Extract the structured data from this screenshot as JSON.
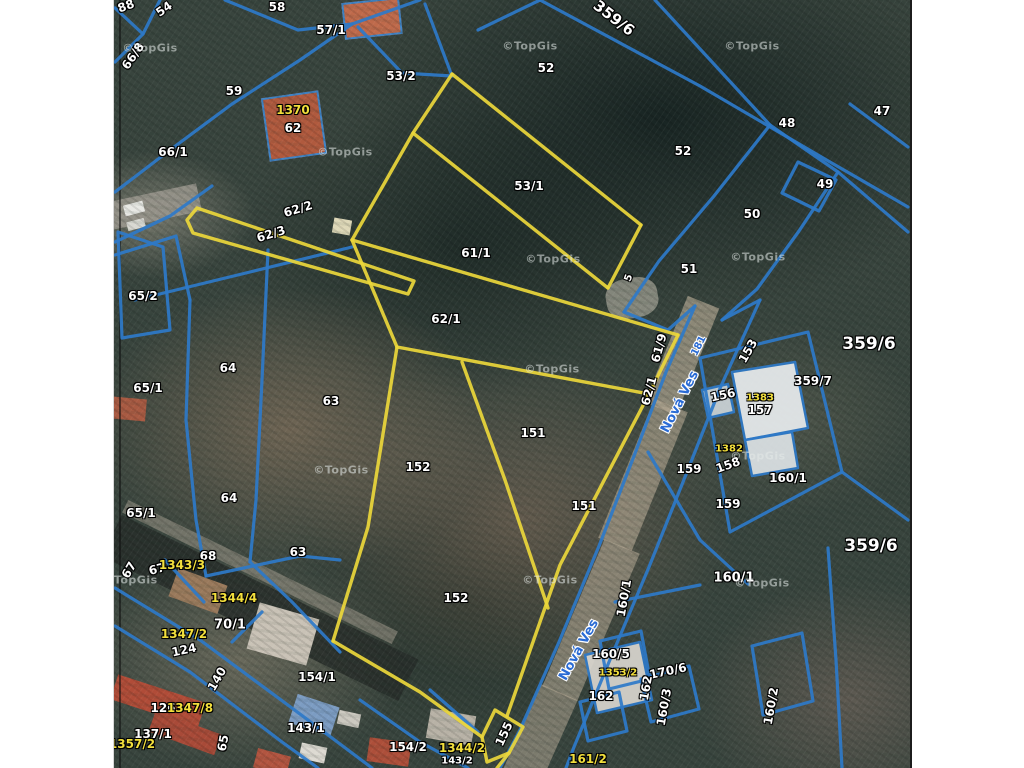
{
  "map": {
    "type": "cadastral-parcel-map-over-aerial-photo",
    "watermark_text": "©TopGis",
    "street_name": "Nová Ves",
    "colors": {
      "parcel_line_blue": "#2e7ac9",
      "highlight_line_yellow": "#ecd73b",
      "label_white": "#ffffff",
      "label_yellow": "#f2df3c",
      "street_label_blue": "#2a6bd4",
      "paper_margin": "#ffffff"
    },
    "highlighted_parcels": [
      "53/1",
      "61/1",
      "62/1",
      "62/3",
      "151",
      "152",
      "155"
    ],
    "labels": [
      {
        "t": "88",
        "x": 126,
        "y": 6,
        "r": -20
      },
      {
        "t": "54",
        "x": 164,
        "y": 9,
        "r": -35
      },
      {
        "t": "58",
        "x": 277,
        "y": 7
      },
      {
        "t": "57/1",
        "x": 331,
        "y": 30
      },
      {
        "t": "53/2",
        "x": 401,
        "y": 76
      },
      {
        "t": "52",
        "x": 546,
        "y": 68
      },
      {
        "t": "359/6",
        "x": 614,
        "y": 18,
        "r": 38,
        "s": 15
      },
      {
        "t": "59",
        "x": 234,
        "y": 91
      },
      {
        "t": "1370",
        "x": 293,
        "y": 110,
        "c": "y"
      },
      {
        "t": "62",
        "x": 293,
        "y": 128
      },
      {
        "t": "66/8",
        "x": 133,
        "y": 56,
        "r": -55
      },
      {
        "t": "66/1",
        "x": 173,
        "y": 152
      },
      {
        "t": "52",
        "x": 683,
        "y": 151
      },
      {
        "t": "48",
        "x": 787,
        "y": 123
      },
      {
        "t": "47",
        "x": 882,
        "y": 111
      },
      {
        "t": "49",
        "x": 825,
        "y": 184
      },
      {
        "t": "50",
        "x": 752,
        "y": 214
      },
      {
        "t": "53/1",
        "x": 529,
        "y": 186
      },
      {
        "t": "51",
        "x": 689,
        "y": 269
      },
      {
        "t": "62/2",
        "x": 298,
        "y": 209,
        "r": -17
      },
      {
        "t": "62/3",
        "x": 271,
        "y": 234,
        "r": -17
      },
      {
        "t": "61/1",
        "x": 476,
        "y": 253
      },
      {
        "t": "5",
        "x": 629,
        "y": 278,
        "r": -70,
        "s": 10
      },
      {
        "t": "65/2",
        "x": 143,
        "y": 296
      },
      {
        "t": "62/1",
        "x": 446,
        "y": 319
      },
      {
        "t": "64",
        "x": 228,
        "y": 368
      },
      {
        "t": "61/9",
        "x": 659,
        "y": 348,
        "r": -75
      },
      {
        "t": "65/1",
        "x": 148,
        "y": 388
      },
      {
        "t": "63",
        "x": 331,
        "y": 401
      },
      {
        "t": "62/1",
        "x": 649,
        "y": 391,
        "r": -75
      },
      {
        "t": "359/6",
        "x": 869,
        "y": 344,
        "s": 17
      },
      {
        "t": "359/7",
        "x": 813,
        "y": 381
      },
      {
        "t": "153",
        "x": 748,
        "y": 351,
        "r": -60
      },
      {
        "t": "156",
        "x": 723,
        "y": 395,
        "r": -12
      },
      {
        "t": "1383",
        "x": 760,
        "y": 398,
        "c": "y",
        "s": 10
      },
      {
        "t": "157",
        "x": 760,
        "y": 410
      },
      {
        "t": "151",
        "x": 533,
        "y": 433
      },
      {
        "t": "1382",
        "x": 729,
        "y": 449,
        "c": "y",
        "s": 10
      },
      {
        "t": "158",
        "x": 728,
        "y": 465,
        "r": -20
      },
      {
        "t": "159",
        "x": 689,
        "y": 469
      },
      {
        "t": "160/1",
        "x": 788,
        "y": 478
      },
      {
        "t": "152",
        "x": 418,
        "y": 467
      },
      {
        "t": "159",
        "x": 728,
        "y": 504
      },
      {
        "t": "151",
        "x": 584,
        "y": 506
      },
      {
        "t": "64",
        "x": 229,
        "y": 498
      },
      {
        "t": "65/1",
        "x": 141,
        "y": 513
      },
      {
        "t": "68",
        "x": 208,
        "y": 556
      },
      {
        "t": "63",
        "x": 298,
        "y": 552
      },
      {
        "t": "67",
        "x": 129,
        "y": 570,
        "r": -60
      },
      {
        "t": "67",
        "x": 157,
        "y": 569,
        "r": -15
      },
      {
        "t": "1343/3",
        "x": 182,
        "y": 565,
        "c": "y"
      },
      {
        "t": "152",
        "x": 456,
        "y": 598
      },
      {
        "t": "359/6",
        "x": 871,
        "y": 546,
        "s": 17
      },
      {
        "t": "160/1",
        "x": 734,
        "y": 578,
        "s": 13
      },
      {
        "t": "160/1",
        "x": 624,
        "y": 598,
        "r": -80
      },
      {
        "t": "1344/4",
        "x": 234,
        "y": 598,
        "c": "y"
      },
      {
        "t": "70/1",
        "x": 230,
        "y": 625,
        "s": 13
      },
      {
        "t": "1347/2",
        "x": 184,
        "y": 634,
        "c": "y"
      },
      {
        "t": "124",
        "x": 184,
        "y": 650,
        "r": -12
      },
      {
        "t": "140",
        "x": 217,
        "y": 679,
        "r": -60
      },
      {
        "t": "154/1",
        "x": 317,
        "y": 677
      },
      {
        "t": "160/5",
        "x": 611,
        "y": 654
      },
      {
        "t": "1353/2",
        "x": 618,
        "y": 673,
        "c": "y",
        "s": 10
      },
      {
        "t": "170/6",
        "x": 668,
        "y": 671,
        "r": -12
      },
      {
        "t": "162",
        "x": 646,
        "y": 688,
        "r": -80
      },
      {
        "t": "162",
        "x": 601,
        "y": 696
      },
      {
        "t": "160/3",
        "x": 664,
        "y": 707,
        "r": -80
      },
      {
        "t": "160/2",
        "x": 771,
        "y": 706,
        "r": -80
      },
      {
        "t": "126",
        "x": 163,
        "y": 708
      },
      {
        "t": "1347/8",
        "x": 190,
        "y": 708,
        "c": "y"
      },
      {
        "t": "137/1",
        "x": 153,
        "y": 734
      },
      {
        "t": "1357/2",
        "x": 132,
        "y": 744,
        "c": "y"
      },
      {
        "t": "143/1",
        "x": 306,
        "y": 728
      },
      {
        "t": "65",
        "x": 223,
        "y": 743,
        "r": -80
      },
      {
        "t": "155",
        "x": 504,
        "y": 734,
        "r": -65
      },
      {
        "t": "154/2",
        "x": 408,
        "y": 747
      },
      {
        "t": "1344/2",
        "x": 462,
        "y": 748,
        "c": "y"
      },
      {
        "t": "143/2",
        "x": 457,
        "y": 761,
        "s": 10
      },
      {
        "t": "161/2",
        "x": 588,
        "y": 759,
        "c": "y"
      },
      {
        "t": "181",
        "x": 699,
        "y": 346,
        "c": "b",
        "r": -63,
        "s": 10
      },
      {
        "t": "Nová Ves",
        "x": 680,
        "y": 402,
        "c": "b",
        "r": -63,
        "s": 13
      },
      {
        "t": "Nová Ves",
        "x": 579,
        "y": 650,
        "c": "b",
        "r": -61,
        "s": 13
      }
    ],
    "watermarks": [
      [
        150,
        48
      ],
      [
        345,
        152
      ],
      [
        530,
        46
      ],
      [
        752,
        46
      ],
      [
        553,
        259
      ],
      [
        758,
        257
      ],
      [
        552,
        369
      ],
      [
        341,
        470
      ],
      [
        130,
        580
      ],
      [
        550,
        580
      ],
      [
        758,
        456
      ],
      [
        762,
        583
      ]
    ]
  }
}
